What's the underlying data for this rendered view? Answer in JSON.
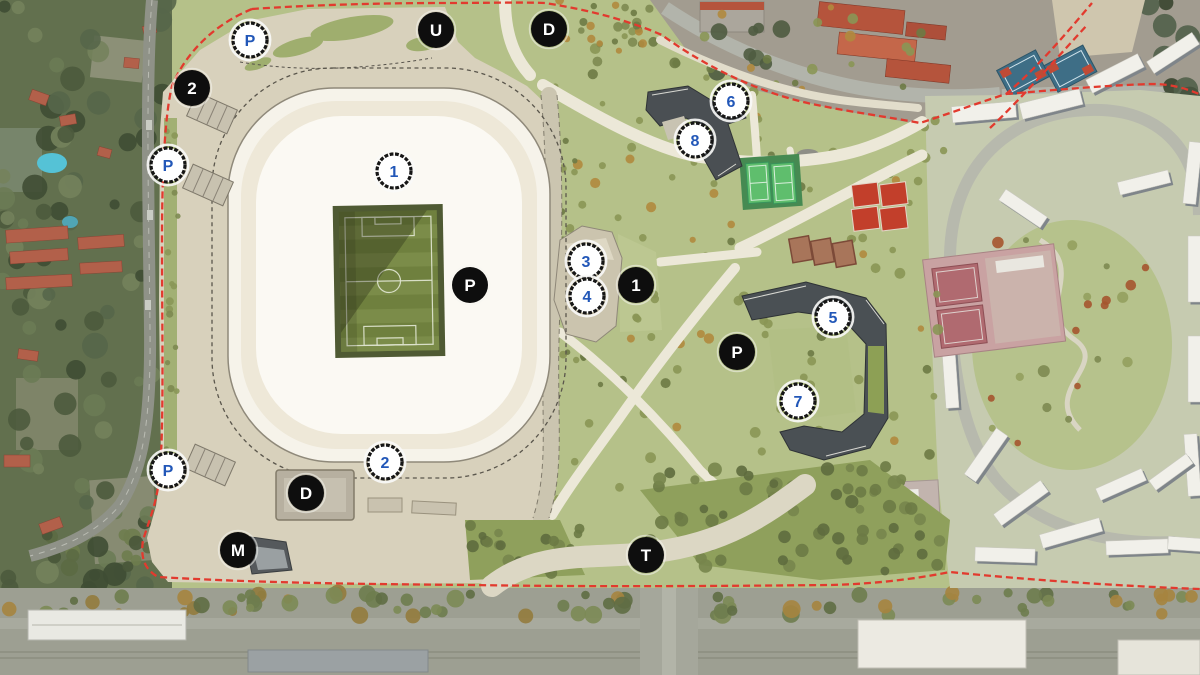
{
  "map": {
    "colors": {
      "boundary_red": "#e23a2e",
      "marker_dark_bg": "#0e0e0e",
      "marker_dark_text": "#ffffff",
      "marker_light_bg": "#ffffff",
      "marker_light_ring": "#161616",
      "marker_light_text": "#2257b8",
      "stadium_white": "#f6f3ea",
      "plaza_beige": "#d8d1bc",
      "park_green": "#b5c189",
      "pitch_green": "#6f803e"
    },
    "markers": [
      {
        "id": "marker-p-northwest",
        "label": "P",
        "variant": "light",
        "x": 250,
        "y": 40
      },
      {
        "id": "marker-gate-2-north",
        "label": "2",
        "variant": "dark",
        "x": 192,
        "y": 88
      },
      {
        "id": "marker-p-west",
        "label": "P",
        "variant": "light",
        "x": 168,
        "y": 165
      },
      {
        "id": "marker-stadium-1",
        "label": "1",
        "variant": "light",
        "x": 394,
        "y": 171
      },
      {
        "id": "marker-u-station",
        "label": "U",
        "variant": "dark",
        "x": 436,
        "y": 30
      },
      {
        "id": "marker-d-north",
        "label": "D",
        "variant": "dark",
        "x": 549,
        "y": 29
      },
      {
        "id": "marker-building-3",
        "label": "3",
        "variant": "light",
        "x": 586,
        "y": 261
      },
      {
        "id": "marker-building-4",
        "label": "4",
        "variant": "light",
        "x": 587,
        "y": 296
      },
      {
        "id": "marker-gate-1-east",
        "label": "1",
        "variant": "dark",
        "x": 636,
        "y": 285
      },
      {
        "id": "marker-p-stadium",
        "label": "P",
        "variant": "dark",
        "x": 470,
        "y": 285
      },
      {
        "id": "marker-building-6",
        "label": "6",
        "variant": "light",
        "x": 731,
        "y": 101
      },
      {
        "id": "marker-building-8",
        "label": "8",
        "variant": "light",
        "x": 695,
        "y": 140
      },
      {
        "id": "marker-building-5",
        "label": "5",
        "variant": "light",
        "x": 833,
        "y": 317
      },
      {
        "id": "marker-p-park",
        "label": "P",
        "variant": "dark",
        "x": 737,
        "y": 352
      },
      {
        "id": "marker-building-7",
        "label": "7",
        "variant": "light",
        "x": 798,
        "y": 401
      },
      {
        "id": "marker-gate-2-south",
        "label": "2",
        "variant": "light",
        "x": 385,
        "y": 462
      },
      {
        "id": "marker-p-southwest",
        "label": "P",
        "variant": "light",
        "x": 168,
        "y": 470
      },
      {
        "id": "marker-d-south",
        "label": "D",
        "variant": "dark",
        "x": 306,
        "y": 493
      },
      {
        "id": "marker-m-station",
        "label": "M",
        "variant": "dark",
        "x": 238,
        "y": 550
      },
      {
        "id": "marker-t-stop",
        "label": "T",
        "variant": "dark",
        "x": 646,
        "y": 555
      }
    ]
  }
}
